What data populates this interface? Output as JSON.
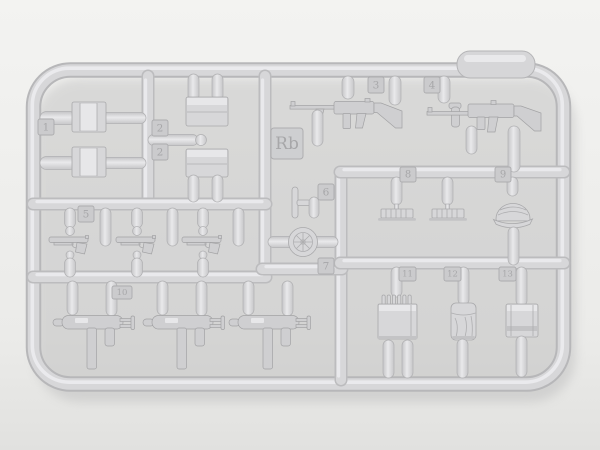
{
  "scene": {
    "description": "Photograph of a light-gray plastic model-kit sprue (runner frame) with small weapon and equipment parts attached",
    "sprue_letter": "Rb"
  },
  "part_tabs": {
    "tab1": "1",
    "tab2a": "2",
    "tab2b": "2",
    "tab3": "3",
    "tab4": "4",
    "tab5": "5",
    "tab6": "6",
    "tab7": "7",
    "tab8": "8",
    "tab9": "9",
    "tab10": "10",
    "tab11": "11",
    "tab12": "12",
    "tab13": "13"
  },
  "colors": {
    "background_top": "#f3f3f1",
    "background_bottom": "#e1e1df",
    "plastic_base": "#d7d7d9",
    "plastic_highlight": "#ececee",
    "plastic_shadow": "#b7b7b9",
    "emboss_text": "#a7a7a9",
    "photo_shadow": "#9b9b9d"
  }
}
